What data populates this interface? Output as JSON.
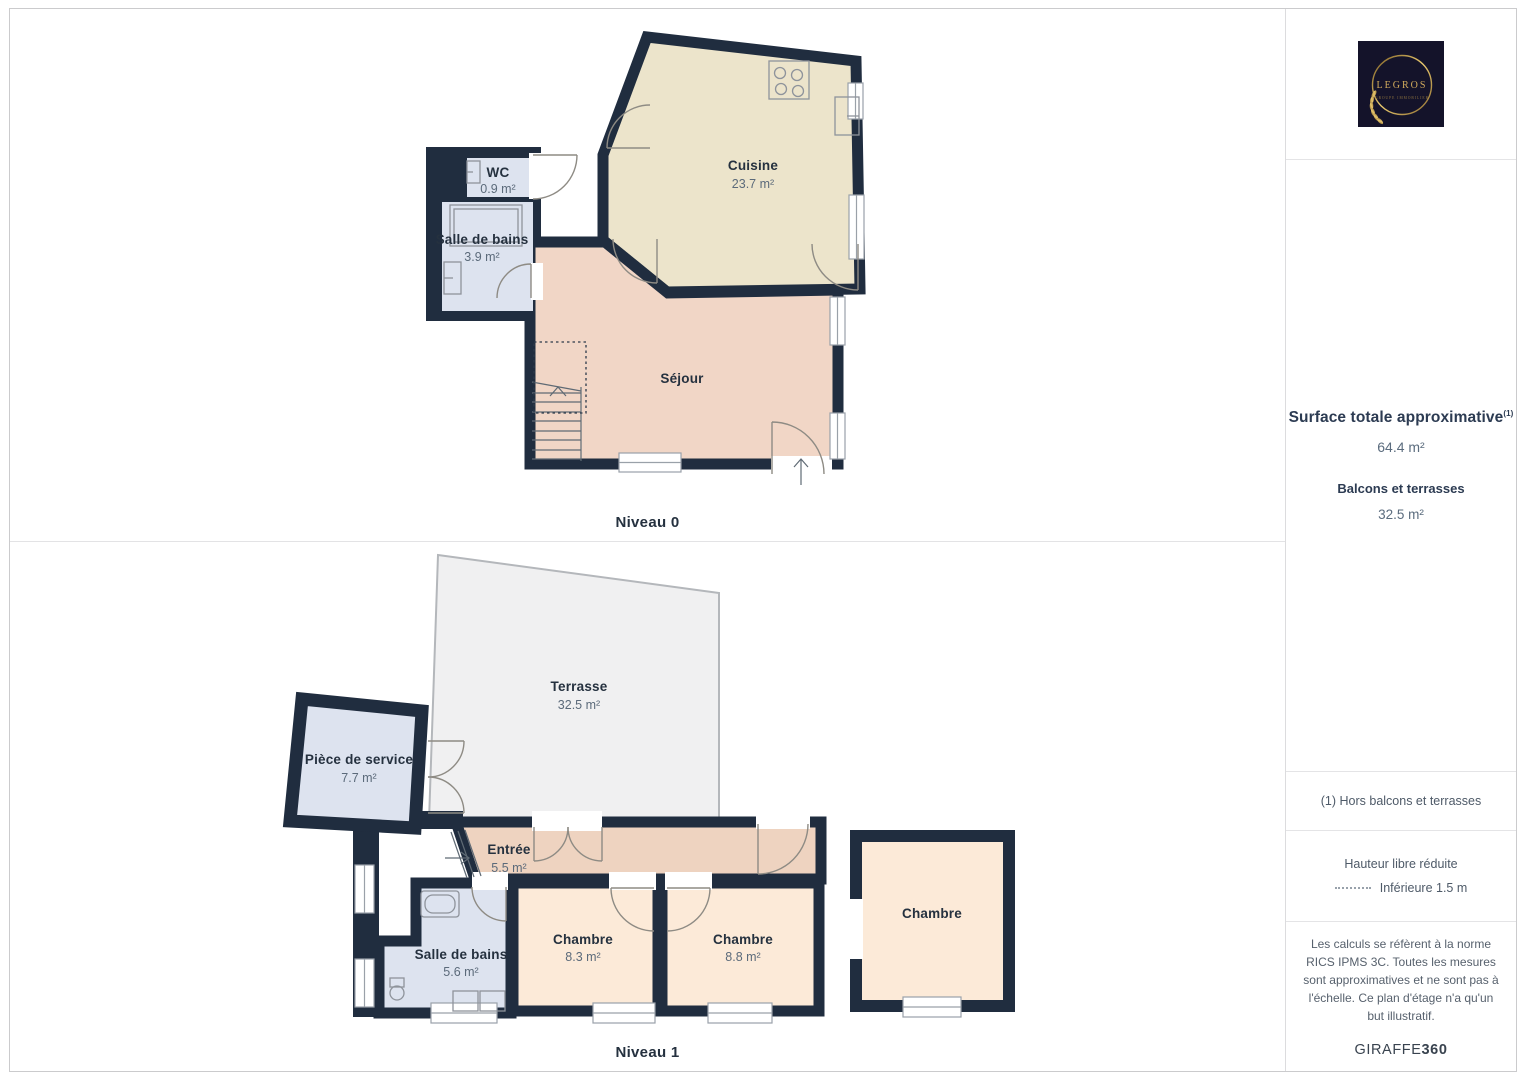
{
  "colors": {
    "wall": "#202d3f",
    "room_cuisine": "#ece4cb",
    "room_sejour": "#f1d6c6",
    "room_entree": "#eed3c0",
    "room_chambre": "#fcead8",
    "room_wet": "#dde3ef",
    "room_terrasse": "#f0f0f1",
    "logo_bg": "#14132a",
    "logo_gold": "#d2ab5c"
  },
  "plans": {
    "level0": {
      "label": "Niveau 0",
      "rooms": [
        {
          "name": "Cuisine",
          "area": "23.7 m²"
        },
        {
          "name": "Séjour",
          "area": ""
        },
        {
          "name": "WC",
          "area": "0.9 m²"
        },
        {
          "name": "Salle de bains",
          "area": "3.9 m²"
        }
      ]
    },
    "level1": {
      "label": "Niveau 1",
      "rooms": [
        {
          "name": "Terrasse",
          "area": "32.5 m²"
        },
        {
          "name": "Pièce de service",
          "area": "7.7 m²"
        },
        {
          "name": "Entrée",
          "area": "5.5 m²"
        },
        {
          "name": "Salle de bains",
          "area": "5.6 m²"
        },
        {
          "name": "Chambre",
          "area": "8.3 m²"
        },
        {
          "name": "Chambre",
          "area": "8.8 m²"
        },
        {
          "name": "Chambre",
          "area": ""
        }
      ]
    }
  },
  "sidebar": {
    "logo": {
      "brand": "LEGROS",
      "tagline": "GROUPE IMMOBILIER"
    },
    "surface": {
      "title": "Surface totale approximative",
      "title_sup": "(1)",
      "total_value": "64.4 m²",
      "balconies_label": "Balcons et terrasses",
      "balconies_value": "32.5 m²"
    },
    "footnote": "(1) Hors balcons et terrasses",
    "legend": {
      "title": "Hauteur libre réduite",
      "item": "Inférieure 1.5 m"
    },
    "disclaimer": "Les calculs se réfèrent à la norme RICS IPMS 3C. Toutes les mesures sont approximatives et ne sont pas à l'échelle. Ce plan d'étage n'a qu'un but illustratif.",
    "brand_footer": {
      "name": "GIRAFFE",
      "suffix": "360"
    }
  }
}
